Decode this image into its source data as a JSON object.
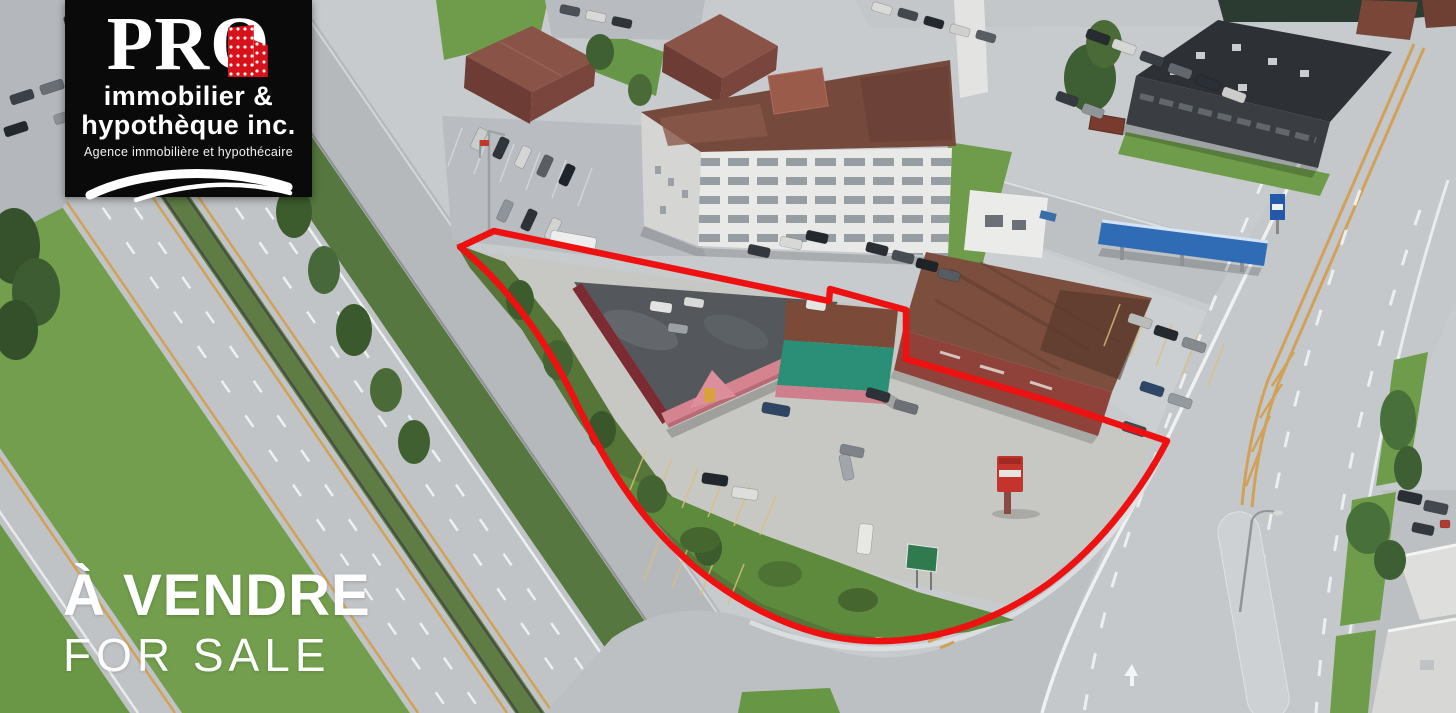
{
  "overlay": {
    "logo": {
      "brand": "PRO",
      "line1": "immobilier &",
      "line2": "hypothèque inc.",
      "tagline": "Agence immobilière et hypothécaire",
      "building_icon": "red-building-icon",
      "swoosh_icon": "swoosh-icon"
    },
    "sale": {
      "title": "À VENDRE",
      "subtitle": "FOR SALE"
    }
  },
  "scene": {
    "colors": {
      "outline_red": "#ed1111",
      "logo_red": "#d8121a",
      "road_gray": "#c1c5c8",
      "grass_green": "#6f9c4a",
      "teal_building": "#2b8f77",
      "awning_pink": "#d4838f",
      "maroon_wall": "#7c2b33",
      "rust_roof": "#7c4e3d",
      "canopy_blue": "#2f6cb5",
      "apartment_roof_brown": "#76493d"
    }
  }
}
